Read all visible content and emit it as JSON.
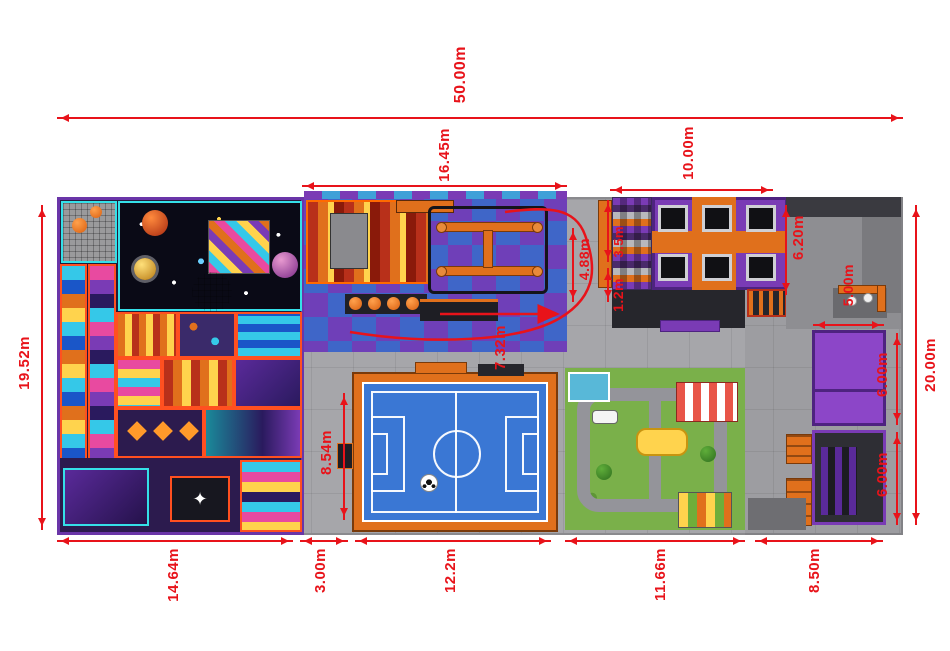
{
  "title": "Indoor playground floor plan (top view)",
  "dimensions": {
    "total_width": "50.00m",
    "ninja_zone_width": "16.45m",
    "trampoline_zone_width": "10.00m",
    "left_height": "19.52m",
    "right_height": "20.00m",
    "upper_room_height": "6.00m",
    "lower_room_height": "6.00m",
    "soft_play_width": "14.64m",
    "corridor_width": "3.00m",
    "pitch_width": "12.2m",
    "kids_zone_width": "11.66m",
    "right_zone_width": "8.50m",
    "pitch_height": "8.54m",
    "track_length": "7.32m",
    "ninja_inner_height": "4.88m",
    "trampoline_side_height": "6.20m",
    "wall_ledge_height": "3.5m",
    "ledge_width": "1.2m",
    "bench_row_width": "5.00m"
  },
  "glyphs": {
    "star": "✦",
    "sparkle": "✦ ✦"
  },
  "colors": {
    "dimension_red": "#e8131a",
    "floor_gray": "#a6a6aa",
    "deck_purple": "#7a3bb5",
    "accent_orange": "#e0701c",
    "pitch_blue": "#3a77d4",
    "grass_green": "#7ab04a"
  }
}
